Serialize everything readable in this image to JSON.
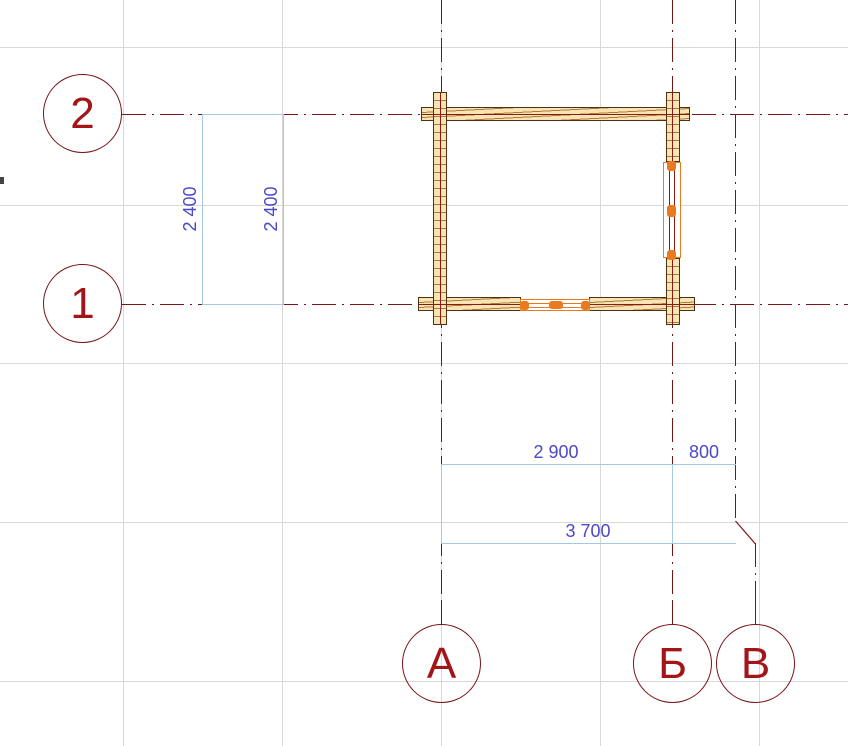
{
  "canvas": {
    "background": "#ffffff",
    "grid_color": "#d9d9d9"
  },
  "axes": {
    "line_color": "#7a1418",
    "label_color": "#a31518",
    "horizontal": [
      {
        "label": "2"
      },
      {
        "label": "1"
      }
    ],
    "vertical": [
      {
        "label": "А"
      },
      {
        "label": "Б"
      },
      {
        "label": "В"
      }
    ]
  },
  "dimensions": {
    "line_color": "#a3c8e4",
    "text_color": "#4a49c8",
    "vertical": [
      {
        "value": "2 400"
      },
      {
        "value": "2 400"
      }
    ],
    "horizontal": [
      {
        "value": "2 900"
      },
      {
        "value": "800"
      },
      {
        "value": "3 700"
      }
    ]
  },
  "structure": {
    "wall_fill": "#f7e4b5",
    "wall_outline": "#503010",
    "grain_color": "#b07a38",
    "centerline_color": "#8b1a10",
    "opening_color": "#ea7a1f"
  }
}
